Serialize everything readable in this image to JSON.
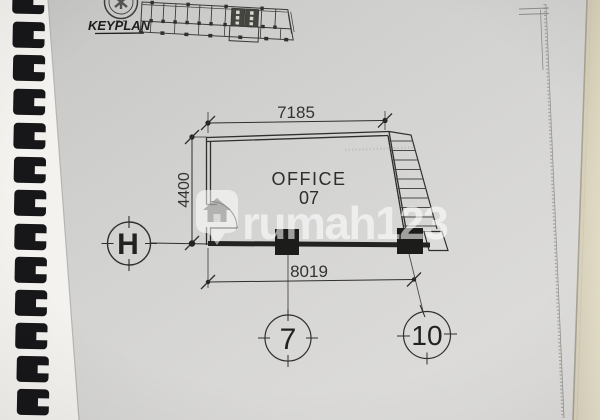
{
  "sheet": {
    "keyplan_label": "KEYPLAN",
    "room": {
      "name": "OFFICE",
      "number": "07"
    },
    "dimensions": {
      "top": "7185",
      "left": "4400",
      "bottom": "8019"
    },
    "grid_bubbles": {
      "row": "H",
      "column_left": "7",
      "column_right": "10"
    },
    "watermark_text": "rumah123",
    "colors": {
      "ink": "#2f2f2d",
      "paper": "#d4d4d2",
      "desk": "#d9d1b7",
      "binding": "#17171a",
      "watermark_white": "#ffffff"
    }
  }
}
